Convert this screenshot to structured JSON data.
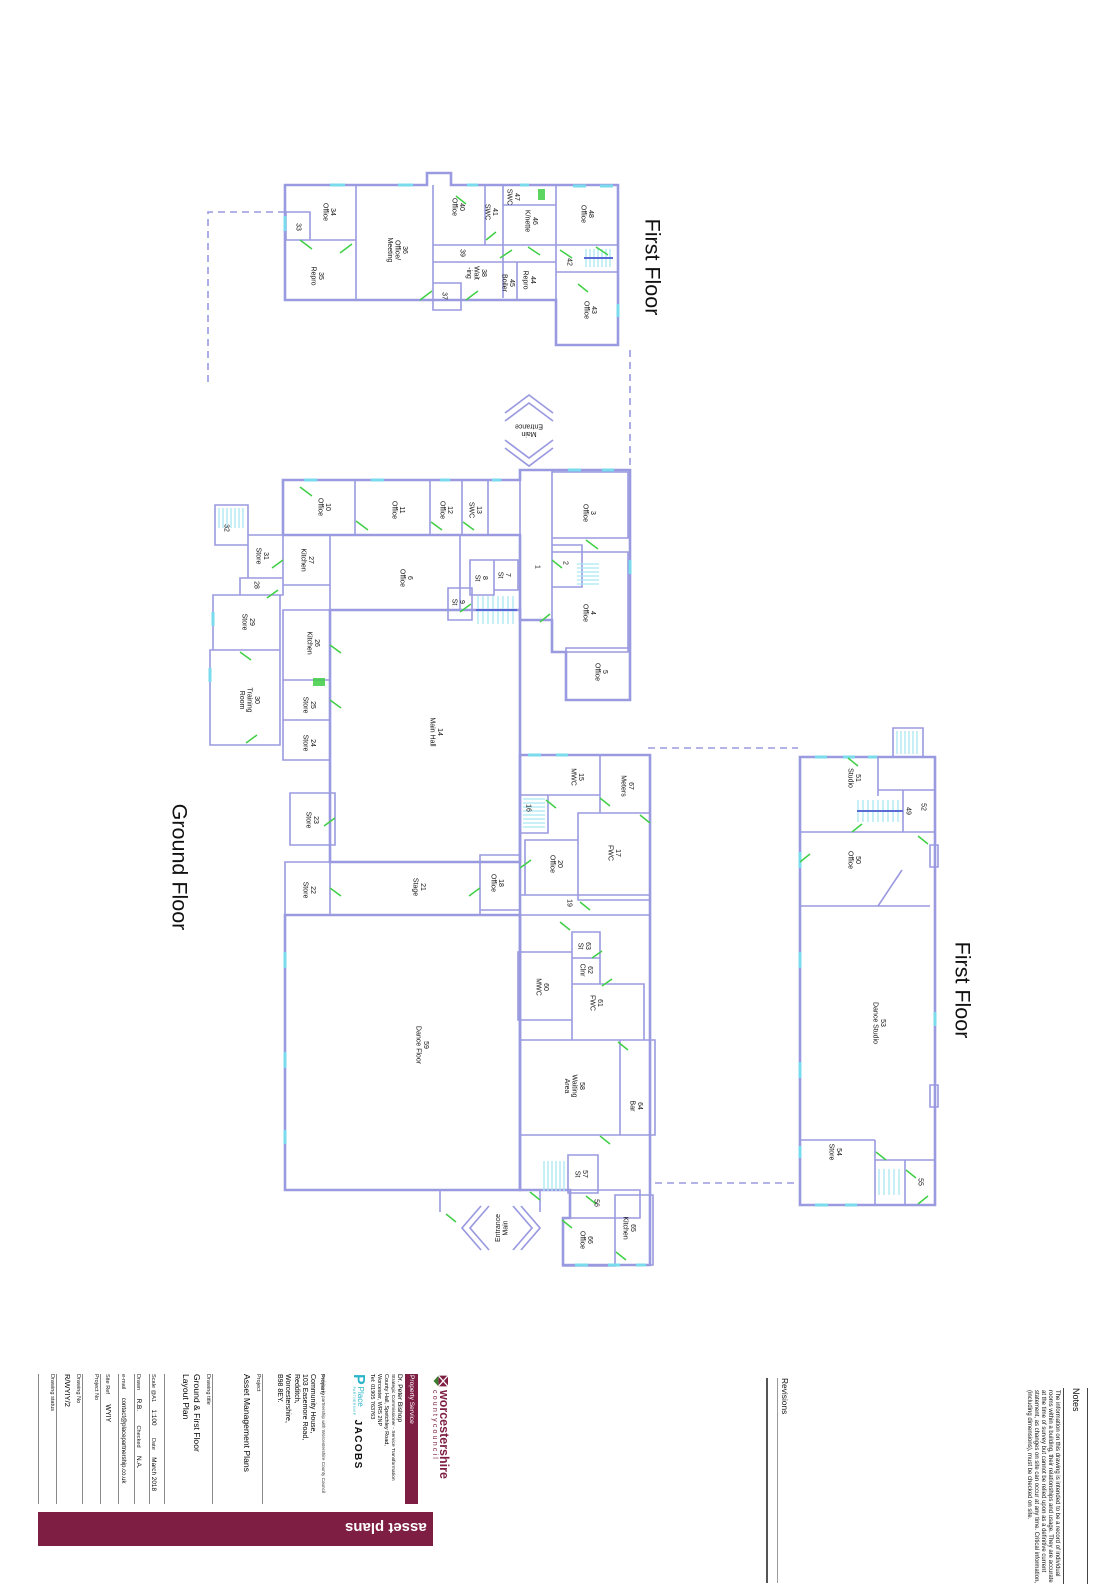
{
  "floorplan": {
    "colors": {
      "wall": "#9a9ae0",
      "window": "#79dbec",
      "door": "#3fcf45",
      "stair": "#a8e6f2",
      "maroon": "#7d1e42",
      "teal": "#2ab5c9"
    },
    "titles": [
      {
        "text": "First Floor",
        "x": 653,
        "y": 267
      },
      {
        "text": "Ground Floor",
        "x": 180,
        "y": 867
      },
      {
        "text": "First Floor",
        "x": 963,
        "y": 990
      }
    ],
    "entrances": [
      {
        "lines": [
          "Main",
          "Entrance"
        ],
        "x": 529,
        "y": 431,
        "rot": 180
      },
      {
        "lines": [
          "Entrance",
          "Main"
        ],
        "x": 501,
        "y": 1228,
        "rot": -90
      }
    ],
    "rooms": [
      {
        "n": "34",
        "t": "Office",
        "x": 330,
        "y": 212
      },
      {
        "n": "33",
        "x": 299,
        "y": 227
      },
      {
        "n": "35",
        "t": "Repro",
        "x": 318,
        "y": 276
      },
      {
        "n": "36",
        "t": "Office/|Meeting",
        "x": 398,
        "y": 250
      },
      {
        "n": "40",
        "t": "Office",
        "x": 459,
        "y": 207
      },
      {
        "n": "41",
        "t": "SWC",
        "x": 492,
        "y": 212
      },
      {
        "n": "47",
        "t": "SWC",
        "x": 514,
        "y": 197
      },
      {
        "n": "46",
        "t": "K/nette",
        "x": 532,
        "y": 221
      },
      {
        "n": "48",
        "t": "Office",
        "x": 588,
        "y": 214
      },
      {
        "n": "39",
        "x": 463,
        "y": 253
      },
      {
        "n": "38",
        "t": "Wait|-ing",
        "x": 477,
        "y": 273
      },
      {
        "n": "45",
        "t": "Boiler",
        "x": 509,
        "y": 283
      },
      {
        "n": "44",
        "t": "Repro",
        "x": 530,
        "y": 280
      },
      {
        "n": "42",
        "x": 570,
        "y": 262
      },
      {
        "n": "43",
        "t": "Office",
        "x": 591,
        "y": 310
      },
      {
        "n": "37",
        "x": 445,
        "y": 296
      },
      {
        "n": "10",
        "t": "Office",
        "x": 325,
        "y": 507
      },
      {
        "n": "11",
        "t": "Office",
        "x": 399,
        "y": 510
      },
      {
        "n": "12",
        "t": "Office",
        "x": 447,
        "y": 510
      },
      {
        "n": "13",
        "t": "SWC",
        "x": 476,
        "y": 510
      },
      {
        "n": "3",
        "t": "Office",
        "x": 590,
        "y": 513
      },
      {
        "n": "27",
        "t": "Kitchen",
        "x": 308,
        "y": 560
      },
      {
        "n": "31",
        "t": "Store",
        "x": 263,
        "y": 556
      },
      {
        "n": "32",
        "x": 227,
        "y": 528
      },
      {
        "n": "28",
        "x": 257,
        "y": 585
      },
      {
        "n": "29",
        "t": "Store",
        "x": 249,
        "y": 622
      },
      {
        "n": "6",
        "t": "Office",
        "x": 407,
        "y": 578
      },
      {
        "n": "1",
        "x": 538,
        "y": 567
      },
      {
        "n": "2",
        "x": 566,
        "y": 563
      },
      {
        "n": "7",
        "t": "St",
        "x": 505,
        "y": 575
      },
      {
        "n": "8",
        "t": "St",
        "x": 482,
        "y": 578
      },
      {
        "n": "9",
        "t": "St",
        "x": 459,
        "y": 602
      },
      {
        "n": "4",
        "t": "Office",
        "x": 590,
        "y": 613
      },
      {
        "n": "5",
        "t": "Office",
        "x": 602,
        "y": 672
      },
      {
        "n": "30",
        "t": "Training|Room",
        "x": 250,
        "y": 700
      },
      {
        "n": "26",
        "t": "Kitchen",
        "x": 314,
        "y": 643
      },
      {
        "n": "25",
        "t": "Store",
        "x": 310,
        "y": 705
      },
      {
        "n": "24",
        "t": "Store",
        "x": 310,
        "y": 743
      },
      {
        "n": "14",
        "t": "Main Hall",
        "x": 437,
        "y": 732
      },
      {
        "n": "23",
        "t": "Store",
        "x": 313,
        "y": 820
      },
      {
        "n": "22",
        "t": "Store",
        "x": 310,
        "y": 890
      },
      {
        "n": "21",
        "t": "Stage",
        "x": 420,
        "y": 887
      },
      {
        "n": "18",
        "t": "Office",
        "x": 498,
        "y": 883
      },
      {
        "n": "15",
        "t": "MWC",
        "x": 578,
        "y": 777
      },
      {
        "n": "67",
        "t": "Meters",
        "x": 628,
        "y": 786
      },
      {
        "n": "16",
        "x": 529,
        "y": 808
      },
      {
        "n": "17",
        "t": "FWC",
        "x": 615,
        "y": 853
      },
      {
        "n": "20",
        "t": "Office",
        "x": 557,
        "y": 864
      },
      {
        "n": "19",
        "x": 570,
        "y": 903
      },
      {
        "n": "63",
        "t": "St",
        "x": 585,
        "y": 946
      },
      {
        "n": "62",
        "t": "Clnr",
        "x": 587,
        "y": 970
      },
      {
        "n": "60",
        "t": "MWC",
        "x": 543,
        "y": 987
      },
      {
        "n": "61",
        "t": "FWC",
        "x": 597,
        "y": 1003
      },
      {
        "n": "59",
        "t": "Dance Floor",
        "x": 423,
        "y": 1045
      },
      {
        "n": "58",
        "t": "Waiting|Area",
        "x": 575,
        "y": 1086
      },
      {
        "n": "64",
        "t": "Bar",
        "x": 637,
        "y": 1106
      },
      {
        "n": "57",
        "t": "St",
        "x": 582,
        "y": 1174
      },
      {
        "n": "56",
        "x": 597,
        "y": 1203
      },
      {
        "n": "66",
        "t": "Office",
        "x": 587,
        "y": 1240
      },
      {
        "n": "65",
        "t": "Kitchen",
        "x": 630,
        "y": 1228
      },
      {
        "n": "51",
        "t": "Studio",
        "x": 855,
        "y": 778
      },
      {
        "n": "49",
        "x": 909,
        "y": 811
      },
      {
        "n": "52",
        "x": 924,
        "y": 807
      },
      {
        "n": "50",
        "t": "Office",
        "x": 855,
        "y": 860
      },
      {
        "n": "53",
        "t": "Dance Studio",
        "x": 880,
        "y": 1023
      },
      {
        "n": "54",
        "t": "Store",
        "x": 836,
        "y": 1152
      },
      {
        "n": "55",
        "x": 921,
        "y": 1182
      }
    ]
  },
  "titleblock": {
    "drawing_status_label": "Drawing status",
    "drawing_no_label": "Drawing No",
    "drawing_no_value": "R/WYIY/2",
    "project_no_label": "Project No",
    "site_ref_label": "Site Ref",
    "site_ref_value": "WYIY",
    "email_label": "e-mail",
    "email_value": "contact@placepartnership.co.uk",
    "drawn_label": "Drawn",
    "drawn_value": "R.B.",
    "checked_label": "Checked",
    "checked_value": "N.A.",
    "scale_label": "Scale @A1",
    "scale_value": "1:100",
    "date_label": "Date",
    "date_value": "March 2018",
    "drawing_title_label": "Drawing title",
    "drawing_title_value_1": "Ground & First Floor",
    "drawing_title_value_2": "Layout Plan",
    "project_label": "Project",
    "project_value": "Asset Management Plans",
    "property_label": "Property",
    "property_lines": [
      "Community House,",
      "103 Easemore Road,",
      "Redditch,",
      "Worcestershire,",
      "B98 8EY."
    ],
    "partnership_note": "working in partnership with Worcestershire County Council",
    "place_p": "P",
    "place_name": "Place",
    "place_sub": "PARTNERSHIP",
    "jacobs": "JACOBS",
    "contact_name": "Dr. Peter Bishop",
    "contact_role": "Strategic Commissioner - Service Transformation",
    "contact_addr1": "County Hall, Spetchley Road,",
    "contact_addr2": "Worcester, WR5 2NP",
    "contact_tel": "Tel: 01905 763763",
    "property_service": "Property Service",
    "council_name": "worcestershire",
    "council_sub": "countycouncil",
    "asset_bar": "asset plans",
    "revisions_label": "Revisions",
    "notes_title": "Notes",
    "notes_body": "The information on this drawing is intended to be a record of individual rooms within a building, their relationships and usage. They are accurate at the time of survey but cannot be relied upon as a definitive current statement, as changes on site can occur at any time. Critical information, (including dimensions), must be checked on site."
  }
}
